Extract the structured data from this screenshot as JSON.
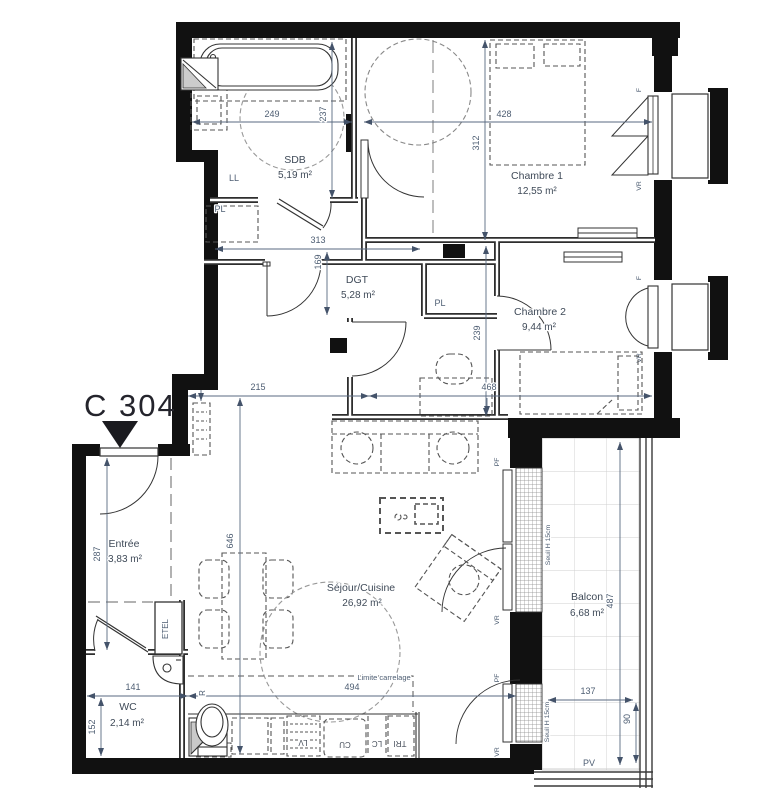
{
  "plan": {
    "unit": "C 304",
    "rooms": {
      "sdb": {
        "name": "SDB",
        "area": "5,19 m²"
      },
      "ch1": {
        "name": "Chambre 1",
        "area": "12,55 m²"
      },
      "dgt": {
        "name": "DGT",
        "area": "5,28 m²"
      },
      "ch2": {
        "name": "Chambre 2",
        "area": "9,44 m²"
      },
      "entree": {
        "name": "Entrée",
        "area": "3,83 m²"
      },
      "sejour": {
        "name": "Séjour/Cuisine",
        "area": "26,92 m²"
      },
      "wc": {
        "name": "WC",
        "area": "2,14 m²"
      },
      "balcon": {
        "name": "Balcon",
        "area": "6,68 m²"
      }
    },
    "dims": {
      "d249": "249",
      "d237": "237",
      "d428": "428",
      "d312": "312",
      "d313": "313",
      "d169": "169",
      "d239": "239",
      "d215": "215",
      "d468": "468",
      "d287": "287",
      "d646": "646",
      "d141": "141",
      "d152": "152",
      "d494": "494",
      "d137": "137",
      "d487": "487",
      "d90": "90"
    },
    "labels": {
      "ll": "LL",
      "pl": "PL",
      "etel": "ETEL",
      "r": "R",
      "lv": "LV",
      "cu": "CU",
      "lc": "LC",
      "tri": "TRI",
      "pf": "PF",
      "vr": "VR",
      "f": "F",
      "pv": "PV",
      "seuil": "Seuil H 15cm",
      "limite": "Limite carrelage"
    },
    "colors": {
      "wall": "#111111",
      "thin": "#2e2e2e",
      "dim": "#4d5d72",
      "text": "#3f4a58"
    }
  }
}
